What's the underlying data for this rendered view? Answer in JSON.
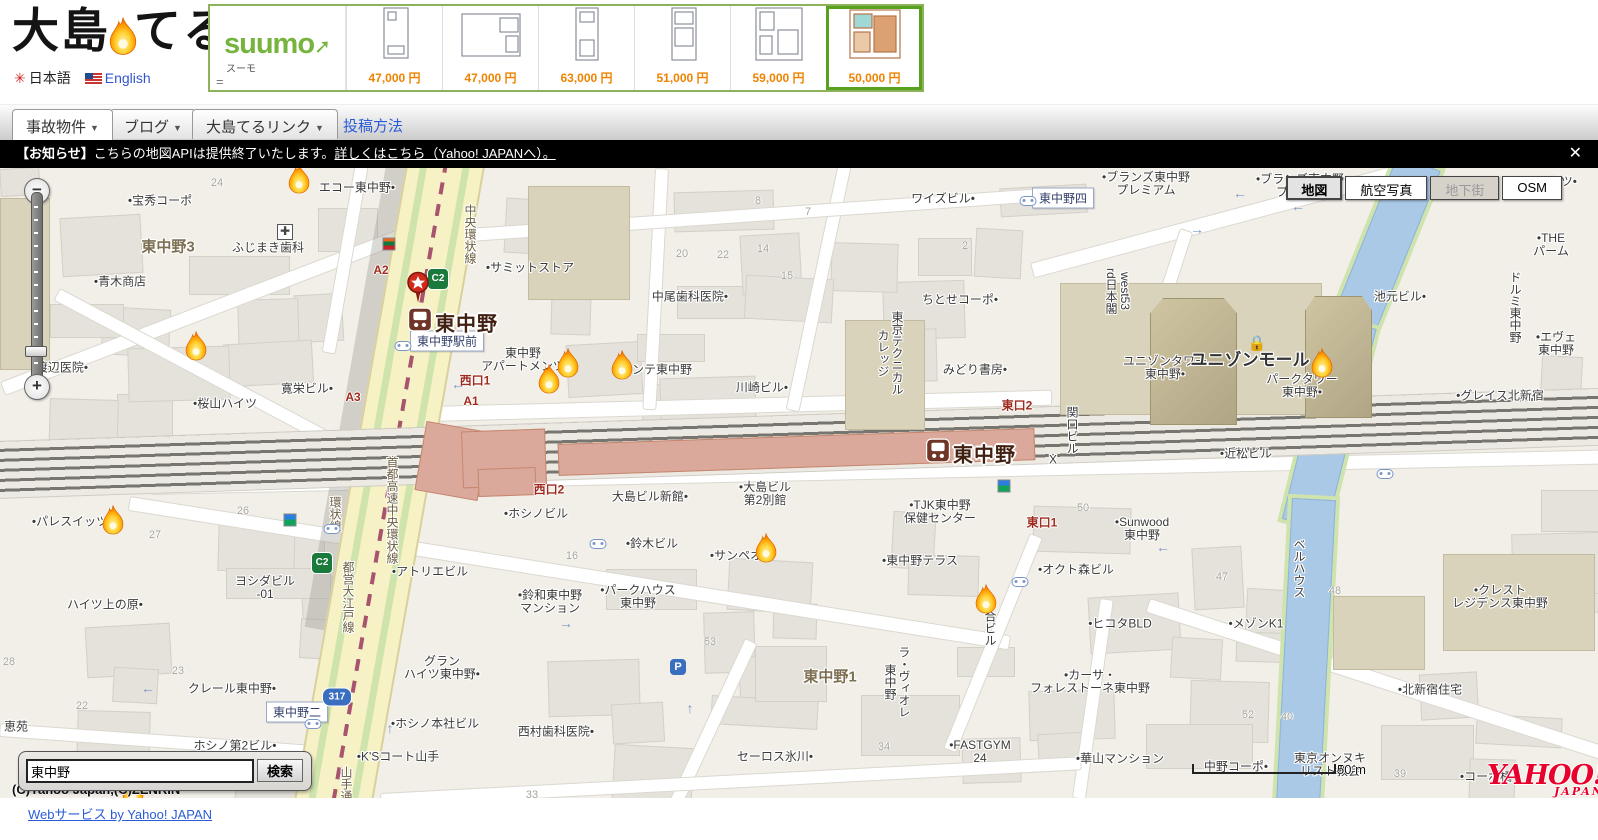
{
  "header": {
    "logo_text_1": "大島",
    "logo_text_2": "てる",
    "lang_jp": "日本語",
    "lang_en": "English",
    "sun_icon": "✳"
  },
  "suumo": {
    "brand": "suumo",
    "brand_arrow": "➚",
    "brand_sub": "スーモ",
    "equals": "=",
    "items": [
      {
        "price": "47,000 円",
        "selected": false
      },
      {
        "price": "47,000 円",
        "selected": false
      },
      {
        "price": "63,000 円",
        "selected": false
      },
      {
        "price": "51,000 円",
        "selected": false
      },
      {
        "price": "59,000 円",
        "selected": false
      },
      {
        "price": "50,000 円",
        "selected": true
      }
    ]
  },
  "nav": {
    "tabs": [
      {
        "label": "事故物件",
        "dropdown": true,
        "active": true,
        "x": 12
      },
      {
        "label": "ブログ",
        "dropdown": true,
        "active": false,
        "x": 110
      },
      {
        "label": "大島てるリンク",
        "dropdown": true,
        "active": false,
        "x": 192
      },
      {
        "label": "投稿方法",
        "dropdown": false,
        "active": false,
        "x": 330,
        "plain": true
      }
    ]
  },
  "notice": {
    "prefix": "【お知らせ】",
    "text": "こちらの地図APIは提供終了いたします。",
    "link_text": "詳しくはこちら（Yahoo! JAPANへ）。",
    "close": "✕"
  },
  "map": {
    "controls": {
      "zoom_out": "−",
      "zoom_in": "+",
      "types": [
        {
          "label": "地図",
          "state": "selected"
        },
        {
          "label": "航空写真",
          "state": "normal"
        },
        {
          "label": "地下街",
          "state": "disabled"
        },
        {
          "label": "OSM",
          "state": "normal"
        }
      ]
    },
    "stations": [
      {
        "name": "東中野",
        "x": 420,
        "y": 154
      },
      {
        "name": "東中野",
        "x": 938,
        "y": 285
      }
    ],
    "pin": {
      "x": 418,
      "y": 122
    },
    "boxed_labels": [
      {
        "t": "東中野駅前",
        "x": 447,
        "y": 173
      },
      {
        "t": "東中野四",
        "x": 1063,
        "y": 30
      },
      {
        "t": "東中野二",
        "x": 297,
        "y": 544
      }
    ],
    "labels": [
      {
        "t": "宝秀コーポ",
        "x": 160,
        "y": 33,
        "d": "l"
      },
      {
        "t": "青木商店",
        "x": 120,
        "y": 114,
        "d": "l"
      },
      {
        "t": "渡辺医院",
        "x": 62,
        "y": 200,
        "d": "r"
      },
      {
        "t": "桜山ハイツ",
        "x": 225,
        "y": 236,
        "d": "l"
      },
      {
        "t": "ふじまき歯科",
        "x": 268,
        "y": 80
      },
      {
        "t": "エコー東中野",
        "x": 357,
        "y": 20,
        "d": "r"
      },
      {
        "t": "ワイズビル",
        "x": 943,
        "y": 31,
        "d": "r"
      },
      {
        "t": "中尾歯科医院",
        "x": 690,
        "y": 129,
        "d": "r"
      },
      {
        "t": "ちとせコーポ",
        "x": 960,
        "y": 132,
        "d": "r"
      },
      {
        "t": "みどり書房",
        "x": 975,
        "y": 202,
        "d": "r"
      },
      {
        "t": "川崎ビル",
        "x": 762,
        "y": 220,
        "d": "r"
      },
      {
        "t": "コンテ東中野",
        "x": 656,
        "y": 202
      },
      {
        "t": "サミットストア",
        "x": 530,
        "y": 100,
        "d": "l"
      },
      {
        "t": "東中野\nアパートメンツ",
        "x": 523,
        "y": 192
      },
      {
        "t": "寛栄ビル",
        "x": 307,
        "y": 221,
        "d": "r"
      },
      {
        "t": "ハイツ上の原",
        "x": 105,
        "y": 437,
        "d": "r"
      },
      {
        "t": "パレスイッツ",
        "x": 70,
        "y": 354,
        "d": "l"
      },
      {
        "t": "ヨシダビル\n-01",
        "x": 265,
        "y": 420
      },
      {
        "t": "アトリエビル",
        "x": 430,
        "y": 404,
        "d": "l"
      },
      {
        "t": "鈴和東中野\nマンション",
        "x": 550,
        "y": 434,
        "d": "l"
      },
      {
        "t": "グラン\nハイツ東中野",
        "x": 442,
        "y": 500,
        "d": "r"
      },
      {
        "t": "クレール東中野",
        "x": 232,
        "y": 521,
        "d": "r"
      },
      {
        "t": "恵苑",
        "x": 16,
        "y": 559
      },
      {
        "t": "ホシノ本社ビル",
        "x": 435,
        "y": 556,
        "d": "l"
      },
      {
        "t": "K'Sコート山手",
        "x": 398,
        "y": 589,
        "d": "l"
      },
      {
        "t": "西村歯科医院",
        "x": 556,
        "y": 564,
        "d": "r"
      },
      {
        "t": "ホシノ第2ビル",
        "x": 235,
        "y": 578,
        "d": "r"
      },
      {
        "t": "セーロス氷川",
        "x": 775,
        "y": 589,
        "d": "r"
      },
      {
        "t": "ホシノビル",
        "x": 536,
        "y": 346,
        "d": "l"
      },
      {
        "t": "大島ビル新館",
        "x": 650,
        "y": 329,
        "d": "r"
      },
      {
        "t": "大島ビル\n第2別館",
        "x": 765,
        "y": 326,
        "d": "l"
      },
      {
        "t": "鈴木ビル",
        "x": 652,
        "y": 376,
        "d": "l"
      },
      {
        "t": "サンペオン",
        "x": 742,
        "y": 388,
        "d": "l"
      },
      {
        "t": "パークハウス\n東中野",
        "x": 638,
        "y": 429,
        "d": "l"
      },
      {
        "t": "東中野テラス",
        "x": 920,
        "y": 393,
        "d": "l"
      },
      {
        "t": "TJK東中野\n保健センター",
        "x": 940,
        "y": 344,
        "d": "l"
      },
      {
        "t": "Sunwood\n東中野",
        "x": 1142,
        "y": 361,
        "d": "l"
      },
      {
        "t": "オクト森ビル",
        "x": 1076,
        "y": 402,
        "d": "l"
      },
      {
        "t": "ヒコタBLD",
        "x": 1120,
        "y": 456,
        "d": "l"
      },
      {
        "t": "メゾンK1",
        "x": 1256,
        "y": 456,
        "d": "l"
      },
      {
        "t": "カーサ・\nフォレストーネ東中野",
        "x": 1090,
        "y": 514,
        "d": "l"
      },
      {
        "t": "FASTGYM\n24",
        "x": 980,
        "y": 584,
        "d": "l"
      },
      {
        "t": "華山マンション",
        "x": 1120,
        "y": 591,
        "d": "l"
      },
      {
        "t": "中野コーポ",
        "x": 1236,
        "y": 599,
        "d": "r"
      },
      {
        "t": "東京オンヌキ\nリスト教会",
        "x": 1330,
        "y": 597
      },
      {
        "t": "近松ビル",
        "x": 1246,
        "y": 286,
        "d": "l"
      },
      {
        "t": "ユニゾンタワー\n東中野",
        "x": 1165,
        "y": 200,
        "d": "r"
      },
      {
        "t": "ユニゾンモール",
        "x": 1250,
        "y": 192,
        "big": 1
      },
      {
        "t": "パークタワー\n東中野",
        "x": 1302,
        "y": 218,
        "d": "r"
      },
      {
        "t": "池元ビル",
        "x": 1400,
        "y": 129,
        "d": "r"
      },
      {
        "t": "ブランズ東中野\nプレミアム",
        "x": 1146,
        "y": 16,
        "d": "l"
      },
      {
        "t": "ブランズ東中野\nプレシア",
        "x": 1300,
        "y": 18,
        "d": "l"
      },
      {
        "t": "グレイス北新宿",
        "x": 1500,
        "y": 228,
        "d": "l"
      },
      {
        "t": "THE\nパーム",
        "x": 1551,
        "y": 77,
        "d": "l"
      },
      {
        "t": "Kハイツ",
        "x": 1553,
        "y": 14,
        "d": "r"
      },
      {
        "t": "エヴェ\n東中野",
        "x": 1556,
        "y": 176,
        "d": "l"
      },
      {
        "t": "北新宿住宅",
        "x": 1430,
        "y": 522,
        "d": "l"
      },
      {
        "t": "クレスト\nレジデンス東中野",
        "x": 1500,
        "y": 429,
        "d": "l"
      },
      {
        "t": "コーポ橘",
        "x": 1486,
        "y": 609,
        "d": "l"
      },
      {
        "t": "東中野1",
        "x": 830,
        "y": 509,
        "dist": 1
      },
      {
        "t": "東中野3",
        "x": 168,
        "y": 79,
        "dist": 1
      },
      {
        "t": "X",
        "x": 1053,
        "y": 292
      },
      {
        "t": "東京テクニカル\nカレッジ",
        "x": 890,
        "y": 143,
        "v": 1
      },
      {
        "t": "west53\nrd日本閣",
        "x": 1118,
        "y": 100,
        "v": 1
      },
      {
        "t": "関口ビル",
        "x": 1072,
        "y": 238,
        "v": 1
      },
      {
        "t": "谷合ビル",
        "x": 990,
        "y": 430,
        "v": 1
      },
      {
        "t": "ラ・ヴィオレ\n東中野",
        "x": 897,
        "y": 478,
        "v": 1
      },
      {
        "t": "ドルミ東中野",
        "x": 1515,
        "y": 103,
        "v": 1
      },
      {
        "t": "ベルハウス",
        "x": 1299,
        "y": 370,
        "v": 1
      },
      {
        "t": "都営大江戸線",
        "x": 348,
        "y": 393,
        "v": 1,
        "c": "#6b5d3f"
      },
      {
        "t": "環状線",
        "x": 335,
        "y": 328,
        "v": 1,
        "c": "#6b5d3f"
      },
      {
        "t": "中央環状線",
        "x": 470,
        "y": 36,
        "v": 1,
        "c": "#6b5d3f"
      },
      {
        "t": "首都高速中央環状線",
        "x": 392,
        "y": 288,
        "v": 1,
        "c": "#6b5d3f"
      },
      {
        "t": "山手通り",
        "x": 346,
        "y": 598,
        "v": 1,
        "c": "#6b5d3f"
      }
    ],
    "exit_labels": [
      {
        "t": "A2",
        "x": 381,
        "y": 102
      },
      {
        "t": "A3",
        "x": 353,
        "y": 229
      },
      {
        "t": "A1",
        "x": 471,
        "y": 233
      },
      {
        "t": "西口1",
        "x": 475,
        "y": 212
      },
      {
        "t": "西口2",
        "x": 549,
        "y": 321
      },
      {
        "t": "東口1",
        "x": 1042,
        "y": 354
      },
      {
        "t": "東口2",
        "x": 1017,
        "y": 237
      }
    ],
    "metro_icons": [
      {
        "t": "C2",
        "x": 438,
        "y": 111
      },
      {
        "t": "C2",
        "x": 322,
        "y": 395
      }
    ],
    "route_shields": [
      {
        "t": "317",
        "x": 337,
        "y": 529
      }
    ],
    "numbers": [
      {
        "t": "24",
        "x": 217,
        "y": 15
      },
      {
        "t": "8",
        "x": 758,
        "y": 33
      },
      {
        "t": "7",
        "x": 808,
        "y": 44
      },
      {
        "t": "14",
        "x": 763,
        "y": 81
      },
      {
        "t": "15",
        "x": 787,
        "y": 108
      },
      {
        "t": "2",
        "x": 965,
        "y": 78
      },
      {
        "t": "20",
        "x": 682,
        "y": 86
      },
      {
        "t": "22",
        "x": 723,
        "y": 87
      },
      {
        "t": "27",
        "x": 155,
        "y": 367
      },
      {
        "t": "26",
        "x": 243,
        "y": 343
      },
      {
        "t": "23",
        "x": 178,
        "y": 503
      },
      {
        "t": "22",
        "x": 82,
        "y": 538
      },
      {
        "t": "28",
        "x": 9,
        "y": 494
      },
      {
        "t": "53",
        "x": 710,
        "y": 474
      },
      {
        "t": "33",
        "x": 532,
        "y": 627
      },
      {
        "t": "34",
        "x": 884,
        "y": 579
      },
      {
        "t": "52",
        "x": 1248,
        "y": 547
      },
      {
        "t": "47",
        "x": 1222,
        "y": 409
      },
      {
        "t": "48",
        "x": 1335,
        "y": 423
      },
      {
        "t": "40",
        "x": 1287,
        "y": 549
      },
      {
        "t": "39",
        "x": 1400,
        "y": 606
      },
      {
        "t": "50",
        "x": 1083,
        "y": 340
      },
      {
        "t": "16",
        "x": 572,
        "y": 388
      }
    ],
    "arrows": [
      {
        "t": "←",
        "x": 458,
        "y": 216
      },
      {
        "t": "→",
        "x": 1197,
        "y": 61
      },
      {
        "t": "←",
        "x": 1008,
        "y": 287
      },
      {
        "t": "←",
        "x": 1298,
        "y": 38
      },
      {
        "t": "→",
        "x": 566,
        "y": 455
      },
      {
        "t": "←",
        "x": 148,
        "y": 520
      },
      {
        "t": "←",
        "x": 1163,
        "y": 379
      },
      {
        "t": "↑",
        "x": 690,
        "y": 540
      },
      {
        "t": "←",
        "x": 1240,
        "y": 25
      },
      {
        "t": "↑",
        "x": 390,
        "y": 560
      }
    ],
    "flames": [
      {
        "x": 299,
        "y": 15
      },
      {
        "x": 196,
        "y": 182
      },
      {
        "x": 568,
        "y": 199
      },
      {
        "x": 549,
        "y": 215
      },
      {
        "x": 622,
        "y": 201
      },
      {
        "x": 766,
        "y": 384
      },
      {
        "x": 986,
        "y": 435
      },
      {
        "x": 1322,
        "y": 199
      },
      {
        "x": 113,
        "y": 356
      },
      {
        "x": 133,
        "y": 627
      }
    ],
    "bus_stops": [
      {
        "x": 403,
        "y": 178
      },
      {
        "x": 1028,
        "y": 33
      },
      {
        "x": 598,
        "y": 376
      },
      {
        "x": 1020,
        "y": 414
      },
      {
        "x": 332,
        "y": 361
      },
      {
        "x": 313,
        "y": 556
      },
      {
        "x": 1385,
        "y": 306
      }
    ],
    "poi": {
      "parking": {
        "t": "P",
        "x": 678,
        "y": 499
      },
      "hospital": {
        "t": "✚",
        "x": 285,
        "y": 64
      },
      "lock": {
        "t": "🔒",
        "x": 1257,
        "y": 175
      },
      "seven": {
        "x": 389,
        "y": 76
      },
      "famima": [
        {
          "x": 290,
          "y": 352
        },
        {
          "x": 1004,
          "y": 318
        }
      ]
    },
    "search": {
      "value": "東中野",
      "button": "検索"
    },
    "copyright": "(C)Yahoo Japan,(C)ZENRIN",
    "scale_label": "50 m",
    "yahoo": {
      "title": "YAHOO!",
      "sub": "JAPAN"
    }
  },
  "footer": {
    "link_label": "Webサービス by Yahoo! JAPAN"
  }
}
